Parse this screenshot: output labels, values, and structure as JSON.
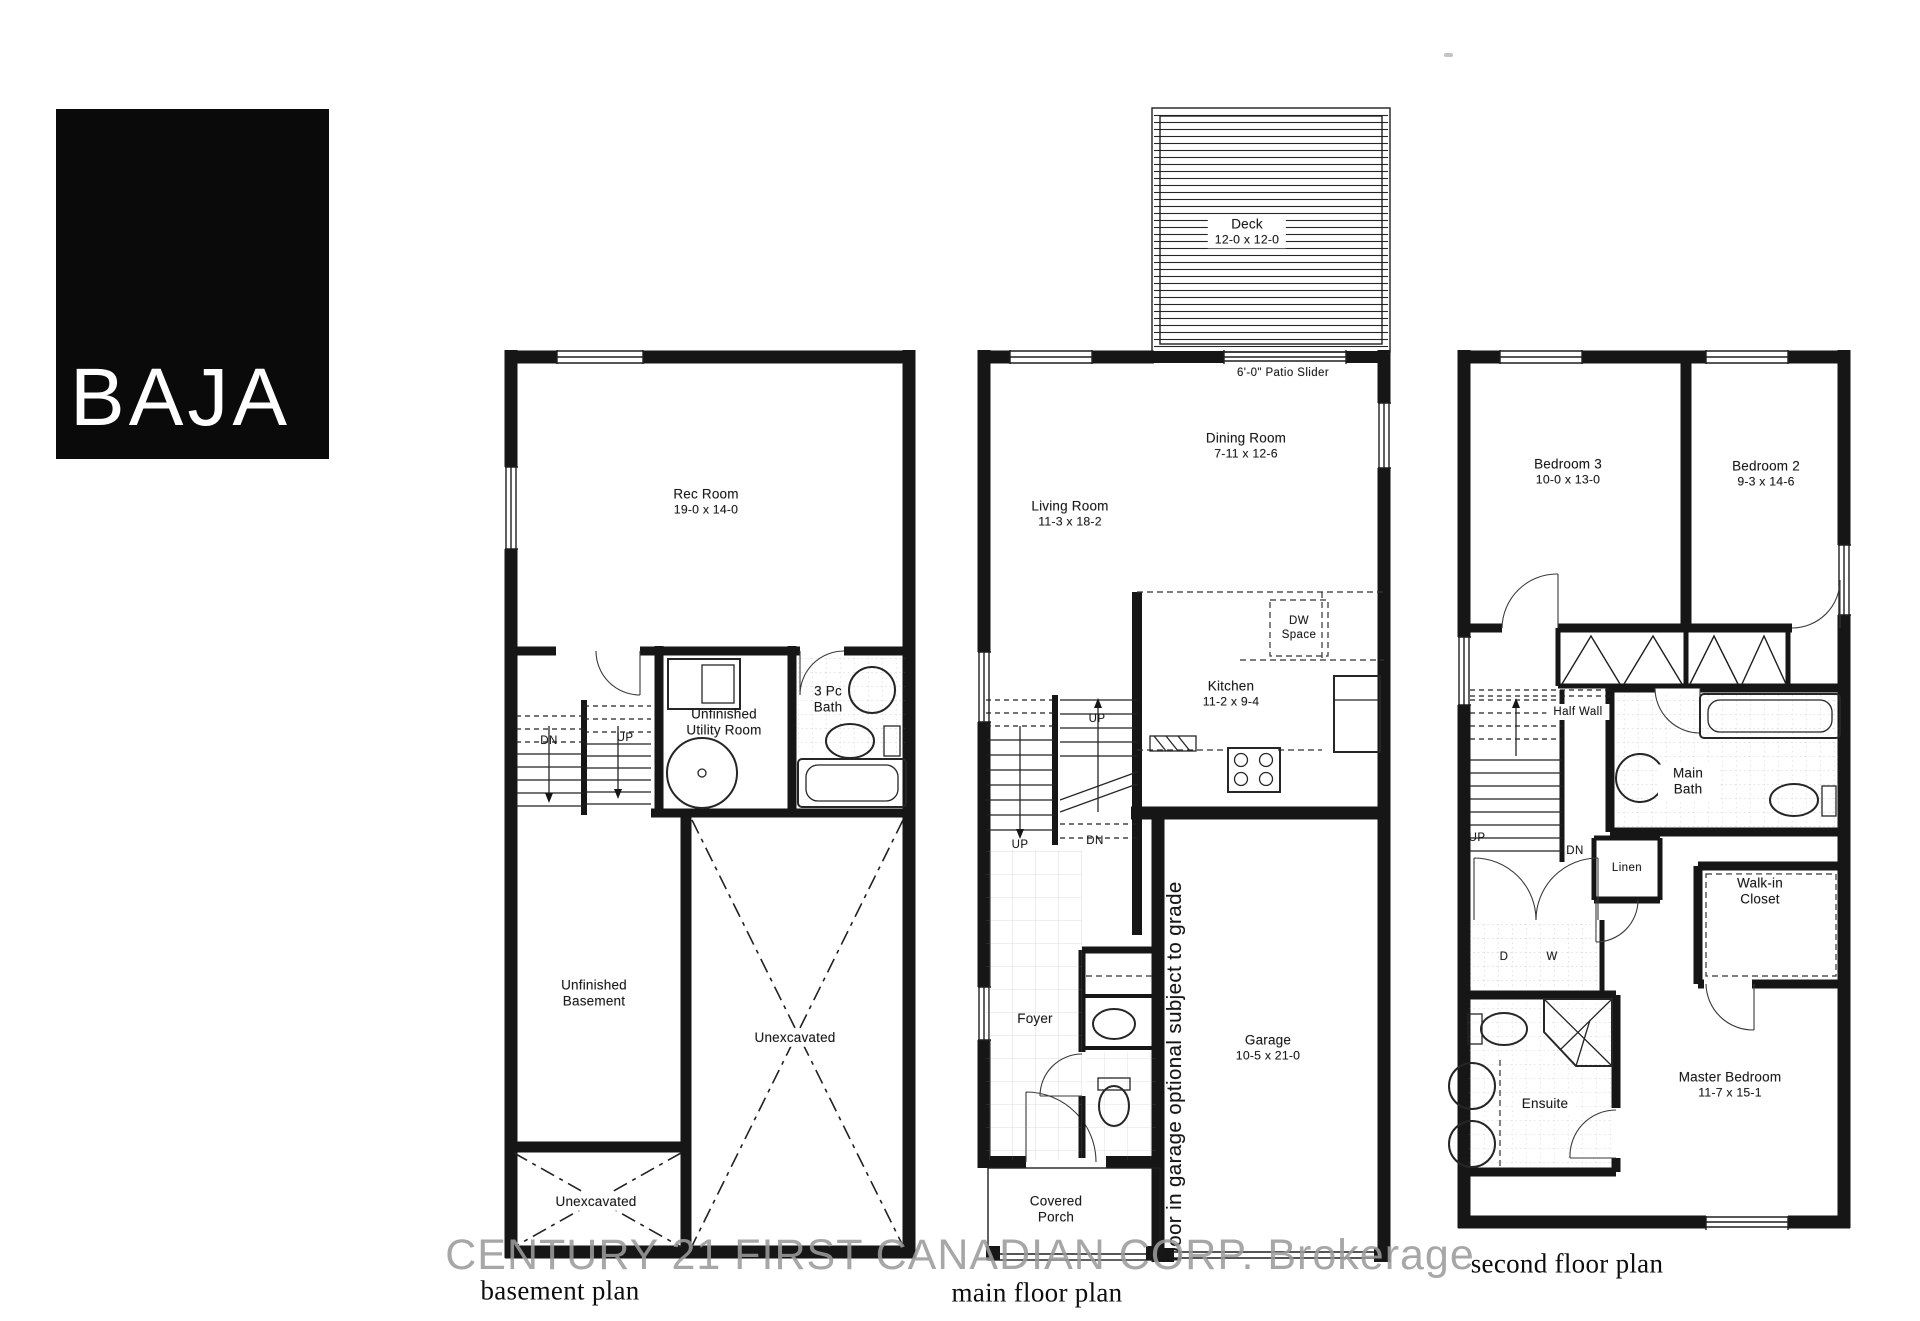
{
  "logo": {
    "text": "BAJA"
  },
  "watermark": {
    "text": "CENTURY 21 FIRST CANADIAN CORP. Brokerage"
  },
  "captions": {
    "basement": "basement plan",
    "main": "main floor plan",
    "second": "second floor plan"
  },
  "basement": {
    "rec_room_name": "Rec Room",
    "rec_room_dims": "19-0 x 14-0",
    "utility_name": "Unfinished Utility Room",
    "bath_name": "3 Pc Bath",
    "unfinished_name": "Unfinished Basement",
    "unexcavated_main": "Unexcavated",
    "unexcavated_small": "Unexcavated",
    "stair_dn": "DN",
    "stair_up": "UP"
  },
  "main_floor": {
    "deck_name": "Deck",
    "deck_dims": "12-0 x 12-0",
    "patio_slider": "6'-0\" Patio Slider",
    "dining_name": "Dining Room",
    "dining_dims": "7-11 x 12-6",
    "living_name": "Living Room",
    "living_dims": "11-3 x 18-2",
    "kitchen_name": "Kitchen",
    "kitchen_dims": "11-2 x 9-4",
    "dw_space": "DW Space",
    "foyer_name": "Foyer",
    "garage_name": "Garage",
    "garage_dims": "10-5 x 21-0",
    "garage_note": "Door in garage optional subject to grade",
    "porch_name": "Covered Porch",
    "stair_up_top": "UP",
    "stair_up_left": "UP",
    "stair_dn": "DN"
  },
  "second_floor": {
    "bedroom3_name": "Bedroom 3",
    "bedroom3_dims": "10-0 x 13-0",
    "bedroom2_name": "Bedroom 2",
    "bedroom2_dims": "9-3 x 14-6",
    "half_wall": "Half Wall",
    "main_bath": "Main Bath",
    "linen": "Linen",
    "walkin": "Walk-in Closet",
    "ensuite": "Ensuite",
    "master_name": "Master Bedroom",
    "master_dims": "11-7 x 15-1",
    "dryer": "D",
    "washer": "W",
    "stair_up": "UP",
    "stair_dn": "DN"
  }
}
